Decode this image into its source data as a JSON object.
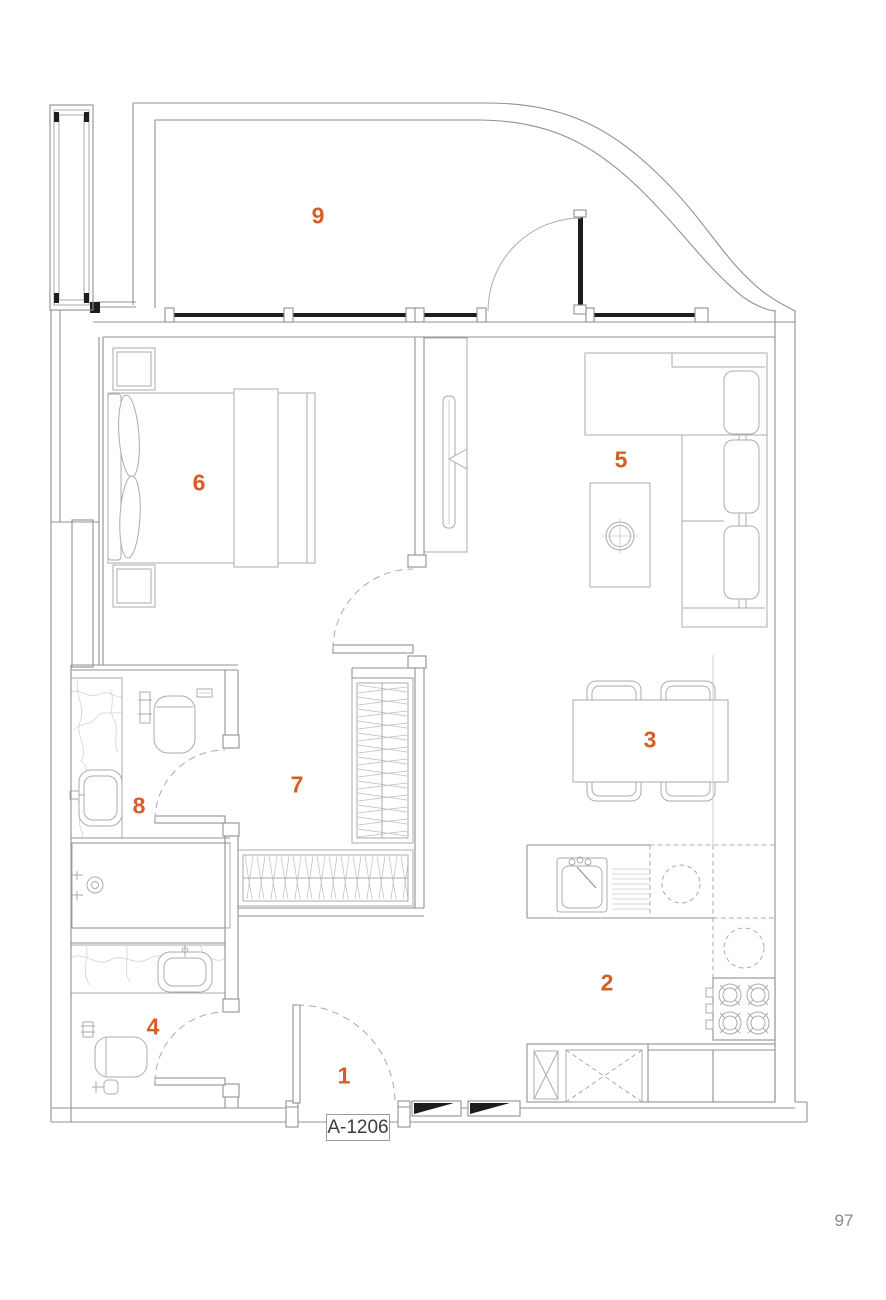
{
  "unit_label": "A-1206",
  "page_number": "97",
  "room_labels": [
    "1",
    "2",
    "3",
    "4",
    "5",
    "6",
    "7",
    "8",
    "9"
  ],
  "colors": {
    "accent": "#d85c28",
    "ink": "#3d3d3d",
    "muted": "#8a8a8a",
    "line": "#9b9b9b",
    "wall": "#8f9193",
    "dark": "#1d1d1f",
    "bg": "#ffffff"
  }
}
